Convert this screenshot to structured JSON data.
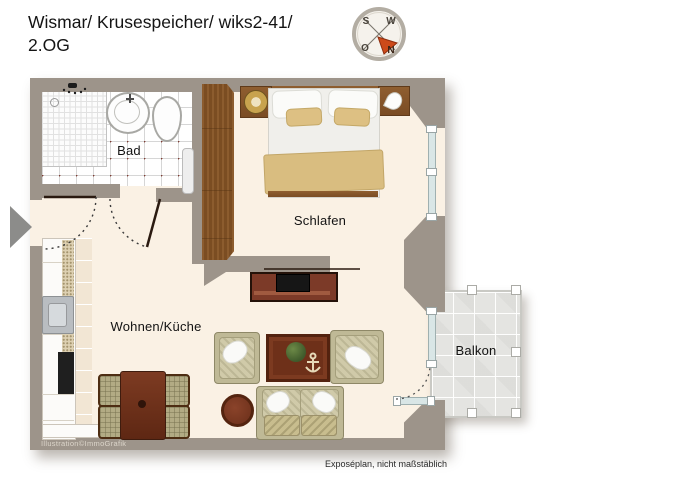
{
  "header": {
    "title_line1": "Wismar/ Krusespeicher/ wiks2-41/",
    "title_line2": "2.OG"
  },
  "compass": {
    "n": "N",
    "o": "O",
    "s": "S",
    "w": "W"
  },
  "rooms": {
    "bathroom": "Bad",
    "bedroom": "Schlafen",
    "living_kitchen": "Wohnen/Küche",
    "balcony": "Balkon"
  },
  "footer": {
    "credit": "Illustration©ImmoGrafik",
    "disclaimer": "Exposéplan, nicht maßstäblich"
  },
  "icons": {
    "compass_rose": "compass-rose pointing north to lower-right",
    "entrance_arrow": "gray triangle marking apartment entrance"
  },
  "colors": {
    "wall": "#9d948a",
    "floor": "#faf1e4",
    "wood_dark": "#6b2f1f",
    "wood_wardrobe": "#81512a",
    "compass_arrow": "#cc4a1a",
    "balcony_tile": "#e4e4e1",
    "upholstery": "#c1ba97",
    "accent_textile": "#d9bd80"
  }
}
